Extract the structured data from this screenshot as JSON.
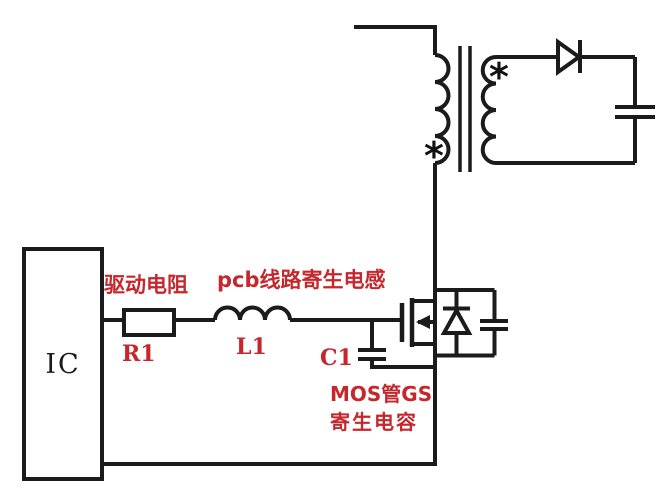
{
  "labels": {
    "ic": "IC",
    "drive_resistor": "驱动电阻",
    "r1": "R1",
    "pcb_trace_inductance": "pcb线路寄生电感",
    "l1": "L1",
    "c1": "C1",
    "mos_gs_line1": "MOS管GS",
    "mos_gs_line2": "寄生电容",
    "primary_dot": "*",
    "secondary_dot": "*"
  },
  "colors": {
    "wire": "#1b1b1b",
    "label_red": "#c5272c",
    "background": "#ffffff"
  }
}
